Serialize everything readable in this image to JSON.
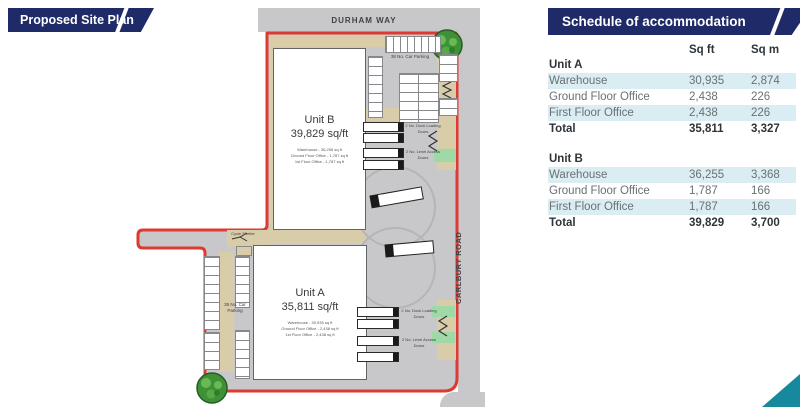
{
  "title_banner": {
    "label": "Proposed Site Plan"
  },
  "site_plan": {
    "roads": {
      "top_label": "DURHAM WAY",
      "right_label": "CARLBURY ROAD"
    },
    "unit_b": {
      "name": "Unit B",
      "area": "39,829 sq/ft",
      "details": [
        "Warehouse - 36,255 sq ft",
        "Ground Floor Office - 1,787 sq ft",
        "1st Floor Office - 1,787 sq ft"
      ]
    },
    "unit_a": {
      "name": "Unit A",
      "area": "35,811 sq/ft",
      "details": [
        "Warehouse - 30,935 sq ft",
        "Ground Floor Office - 2,438 sq ft",
        "1st Floor Office - 2,438 sq ft"
      ]
    },
    "labels": {
      "car_parking_top": "38 No. Car Parking",
      "car_parking_left": "35 No. Car Parking",
      "cycle_shelter": "Cycle Shelter",
      "dock_loading_doors": "2 No. Dock Loading Doors",
      "level_access_doors": "2 No. Level Access Doors"
    }
  },
  "schedule": {
    "title": "Schedule of accommodation",
    "columns": {
      "sqft": "Sq ft",
      "sqm": "Sq m"
    },
    "unit_a": {
      "name": "Unit A",
      "rows": [
        [
          "Warehouse",
          "30,935",
          "2,874"
        ],
        [
          "Ground Floor Office",
          "2,438",
          "226"
        ],
        [
          "First Floor Office",
          "2,438",
          "226"
        ]
      ],
      "total": [
        "Total",
        "35,811",
        "3,327"
      ]
    },
    "unit_b": {
      "name": "Unit B",
      "rows": [
        [
          "Warehouse",
          "36,255",
          "3,368"
        ],
        [
          "Ground Floor Office",
          "1,787",
          "166"
        ],
        [
          "First Floor Office",
          "1,787",
          "166"
        ]
      ],
      "total": [
        "Total",
        "39,829",
        "3,700"
      ]
    }
  },
  "colors": {
    "navy": "#1f2a68",
    "boundary_red": "#dd3a31",
    "road_gray": "#c8c8ca",
    "pavement_tan": "#d9cca9",
    "table_stripe": "#d9edf2",
    "accent_teal": "#168a9c",
    "landscape_green": "#9ed9a7"
  }
}
